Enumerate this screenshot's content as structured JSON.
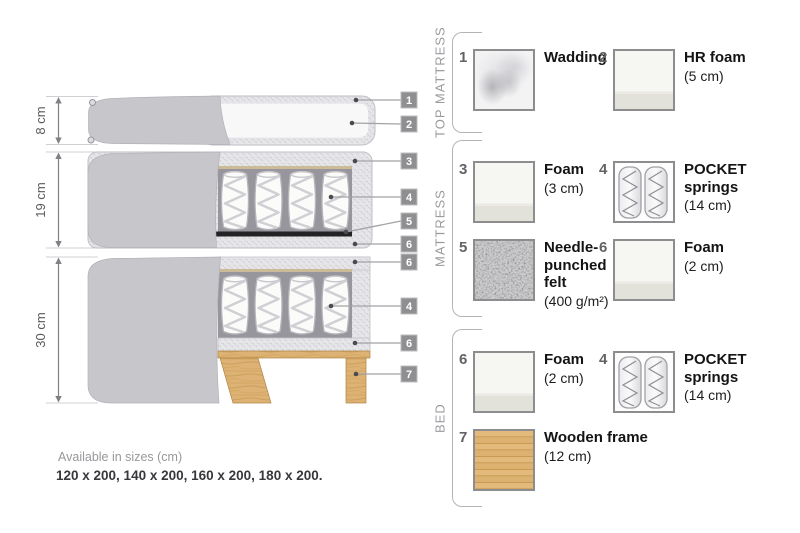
{
  "diagram": {
    "dim_labels": [
      "8 cm",
      "19 cm",
      "30 cm"
    ],
    "tags": [
      "1",
      "2",
      "3",
      "4",
      "5",
      "6",
      "6",
      "4",
      "6",
      "7"
    ]
  },
  "legend": {
    "sections": [
      {
        "title": "TOP MATTRESS",
        "items": [
          {
            "num": "1",
            "name": "Wadding",
            "size": "",
            "swatch": "wadding"
          },
          {
            "num": "2",
            "name": "HR foam",
            "size": "(5 cm)",
            "swatch": "foam"
          }
        ]
      },
      {
        "title": "MATTRESS",
        "items": [
          {
            "num": "3",
            "name": "Foam",
            "size": "(3 cm)",
            "swatch": "foam"
          },
          {
            "num": "4",
            "name": "POCKET springs",
            "size": "(14 cm)",
            "swatch": "pocket-springs"
          },
          {
            "num": "5",
            "name": "Needle-punched felt",
            "size": "(400 g/m²)",
            "swatch": "felt"
          },
          {
            "num": "6",
            "name": "Foam",
            "size": "(2 cm)",
            "swatch": "foam"
          }
        ]
      },
      {
        "title": "BED",
        "items": [
          {
            "num": "6",
            "name": "Foam",
            "size": "(2 cm)",
            "swatch": "foam"
          },
          {
            "num": "4",
            "name": "POCKET springs",
            "size": "(14 cm)",
            "swatch": "pocket-springs"
          },
          {
            "num": "7",
            "name": "Wooden frame",
            "size": "(12 cm)",
            "swatch": "wood"
          }
        ]
      }
    ]
  },
  "footer": {
    "sizes_label": "Available in sizes (cm)",
    "sizes_values": "120 x 200, 140 x 200, 160 x 200, 180 x 200."
  },
  "colors": {
    "cover_gray": "#c6c6cb",
    "speckle_base": "#e6e6e9",
    "felt_dark": "#232325",
    "wood": "#deb274",
    "tag_bg": "#8f8f92"
  }
}
